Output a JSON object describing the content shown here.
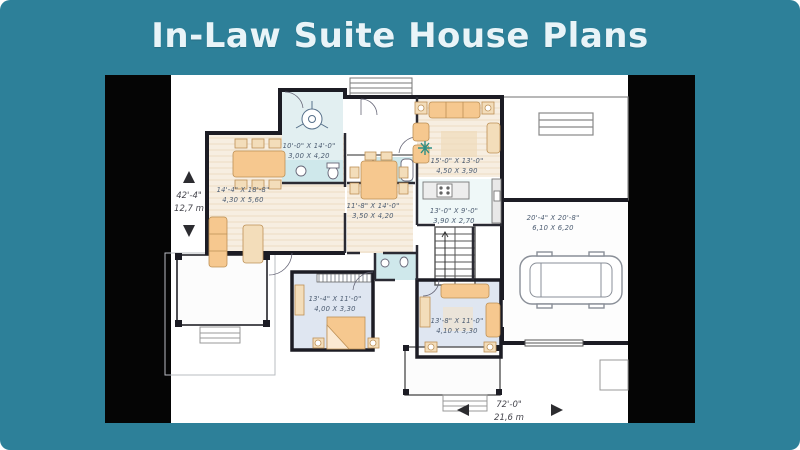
{
  "title": "In-Law Suite House Plans",
  "colors": {
    "background": "#2d8099",
    "title_text": "#e9f4f8",
    "pillarbox": "#050505",
    "wall": "#1c1c24",
    "furniture": "#f6c88f",
    "bath_tile": "#cfe8eb",
    "bedroom_floor": "#dfe6f1",
    "label_text": "#4d5d72"
  },
  "floor_plan": {
    "rooms": [
      {
        "name": "dining-left",
        "imperial": "14'-4\" X 18'-8\"",
        "metric": "4,30 X 5,60"
      },
      {
        "name": "kitchen-left",
        "imperial": "10'-0\" X 14'-0\"",
        "metric": "3,00 X 4,20"
      },
      {
        "name": "living-right",
        "imperial": "15'-0\" X 13'-0\"",
        "metric": "4,50 X 3,90"
      },
      {
        "name": "dining-right",
        "imperial": "11'-8\" X 14'-0\"",
        "metric": "3,50 X 4,20"
      },
      {
        "name": "kitchen-right",
        "imperial": "13'-0\" X 9'-0\"",
        "metric": "3,90 X 2,70"
      },
      {
        "name": "garage",
        "imperial": "20'-4\" X 20'-8\"",
        "metric": "6,10 X 6,20"
      },
      {
        "name": "bedroom-left",
        "imperial": "13'-4\" X 11'-0\"",
        "metric": "4,00 X 3,30"
      },
      {
        "name": "bedroom-right",
        "imperial": "13'-8\" X 11'-0\"",
        "metric": "4,10 X 3,30"
      }
    ],
    "overall_depth": {
      "imperial": "42'-4\"",
      "metric": "12,7 m"
    },
    "overall_width": {
      "imperial": "72'-0\"",
      "metric": "21,6 m"
    }
  }
}
